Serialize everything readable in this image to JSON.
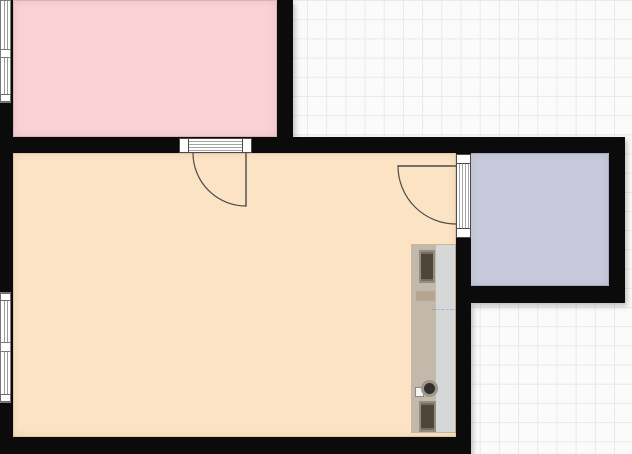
{
  "canvas": {
    "width_px": 632,
    "height_px": 454,
    "background": "#fbfbfb",
    "grid_line_color": "#e9e9e9",
    "grid_size_px": 19.2
  },
  "walls": {
    "color": "#0b0b0b"
  },
  "rooms": {
    "pink": {
      "fill": "#f8d2d4",
      "outline": "#dbb3b6"
    },
    "peach": {
      "fill": "#fce3c4",
      "outline": "#e4c79f"
    },
    "lavender": {
      "fill": "#c8cadc",
      "outline": "#a5a8c2"
    }
  },
  "openings": {
    "frame_color": "#4a4a4a",
    "stripe_color": "#a6a6a6",
    "door_line_color": "#4b4b4b",
    "glass_line_color": "#9a9a9a",
    "threshold_fill": "#ffffff"
  },
  "furniture": {
    "counter_left_fill": "#c3b9ab",
    "counter_right_fill": "#d6d8d7",
    "appliance_fill": "#4e4639",
    "appliance_frame": "#958c7f",
    "sink_basin_fill": "#33302b",
    "sink_ring_color": "#9d978c",
    "guide_line_color": "rgba(110,125,230,0.45)"
  }
}
